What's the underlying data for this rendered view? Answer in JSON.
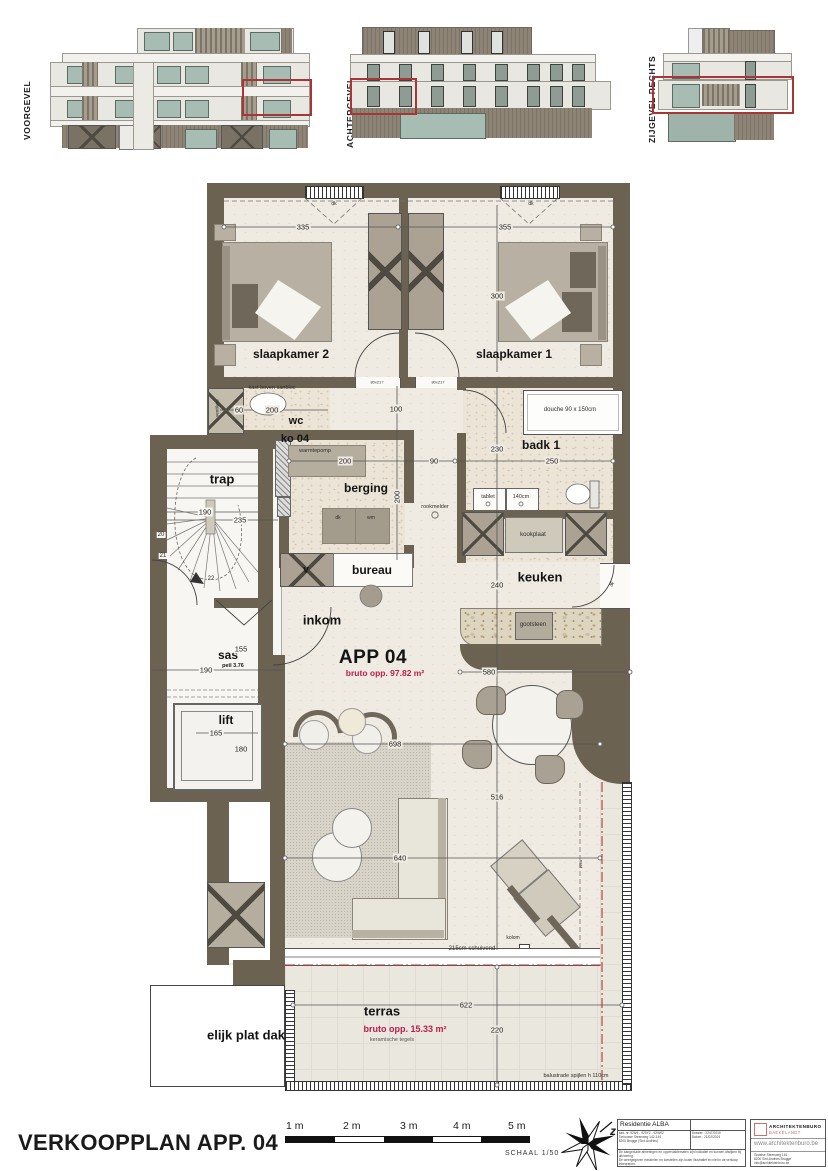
{
  "elevations": [
    {
      "label": "VOORGEVEL"
    },
    {
      "label": "ACHTERGEVEL"
    },
    {
      "label": "ZIJGEVEL RECHTS"
    }
  ],
  "plan": {
    "labels": {
      "slaapkamer2": "slaapkamer 2",
      "slaapkamer1": "slaapkamer 1",
      "wc": "wc",
      "ko04": "ko 04",
      "badk1": "badk 1",
      "berging": "berging",
      "trap": "trap",
      "sas": "sas",
      "peil": "peil 3.76",
      "lift": "lift",
      "bureau": "bureau",
      "v": "v",
      "inkom": "inkom",
      "keuken": "keuken",
      "app": "APP 04",
      "app_area": "bruto opp. 97.82 m²",
      "terras": "terras",
      "terras_area": "bruto opp. 15.33 m²",
      "terras_note": "keramische  tegels",
      "platdak": "elijk plat dak",
      "kast": "kast  boven  sanbloc",
      "ventilatie": "ventilatie",
      "warmtepomp": "warmtepomp",
      "rookmelder": "rookmelder",
      "douche": "douche  90 x 150cm",
      "tablet": "tablet",
      "tablet2": "140cm",
      "kookplaat": "kookplaat",
      "gootsteen": "gootsteen",
      "schuivend": "215cm  schuivend",
      "vast": "vast",
      "kolom": "kolom",
      "balustrade": "balustrade  spijlen  h  110cm",
      "dk_raam": "dk",
      "deur": "80x217",
      "dk": "dk",
      "wm": "wm",
      "dp": "dp"
    },
    "dims": [
      "335",
      "355",
      "300",
      "60",
      "200",
      "100",
      "230",
      "250",
      "200",
      "90",
      "200",
      "190",
      "235",
      "20",
      "21",
      "22",
      "155",
      "190",
      "165",
      "180",
      "240",
      "580",
      "698",
      "516",
      "640",
      "622",
      "220"
    ]
  },
  "footer": {
    "title": "VERKOOPPLAN APP. 04",
    "scale_labels": [
      "1 m",
      "2 m",
      "3 m",
      "4 m",
      "5 m"
    ],
    "scale_caption": "SCHAAL 1/50",
    "north_letter": "z",
    "titleblock": {
      "project": "Residentie ALBA",
      "addr1": "kad. nr. 928/4 - 929Y2 - 929W2",
      "addr2": "Torhoutse Steenweg 142-144",
      "addr3": "8200 Brugge (Sint-Andries)",
      "dossier": "Dossier : 2247/2019",
      "datum": "Datum : 21/02/2024",
      "disclaimer1": "De aangeduide afmetingen en oppervlaktematen zijn indicatief en kunnen afwijken bij uitvoering.",
      "disclaimer2": "De weergegeven meubelen en toestellen zijn louter illustratief en niet in de verkoop inbegrepen."
    },
    "architect": {
      "name": "ARCHITEKTENBURO",
      "sub": "BAEKELANDT",
      "site": "www.architektenburo.be",
      "addr1": "Gistelse Steenweg 161",
      "addr2": "8200 Sint-Andries Brugge",
      "addr3": "info@architektenburo.be"
    }
  },
  "colors": {
    "wall": "#6b6252",
    "floor": "#efebe2",
    "teal": "#a7bcb2",
    "clad": "#8d8476",
    "redout": "#a83636",
    "redtext": "#bb1e4c",
    "redline": "#b23737",
    "furn": "#b8b1a3",
    "furndark": "#6f675a"
  }
}
